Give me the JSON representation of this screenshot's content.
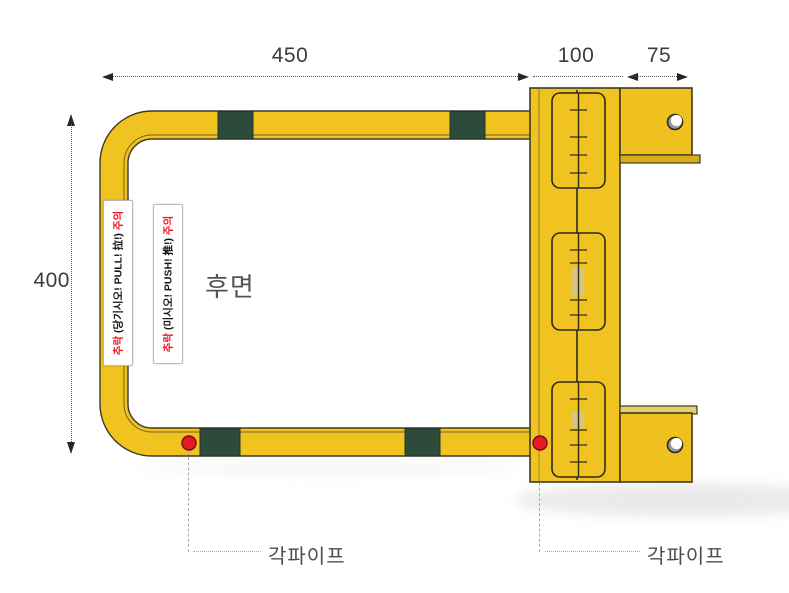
{
  "diagram": {
    "view_label": "후면",
    "dims": {
      "top": {
        "d450": "450",
        "d100": "100",
        "d75": "75"
      },
      "left": {
        "d400": "400"
      }
    },
    "warning_stickers": {
      "pull": {
        "prefix": "추락",
        "body": "(당기시오! PULL! 拉!)",
        "suffix": "주의"
      },
      "push": {
        "prefix": "추락",
        "body": "(미시오! PUSH! 推!)",
        "suffix": "주의"
      }
    },
    "part_labels": {
      "left": "각파이프",
      "right": "각파이프"
    },
    "colors": {
      "tube_yellow": "#F0C320",
      "band_green": "#2C4B3B",
      "outline": "#3f3a26",
      "marker_red": "#E41B23",
      "warning_red": "#ED1B24",
      "dim_text": "#3c3c3c"
    }
  }
}
